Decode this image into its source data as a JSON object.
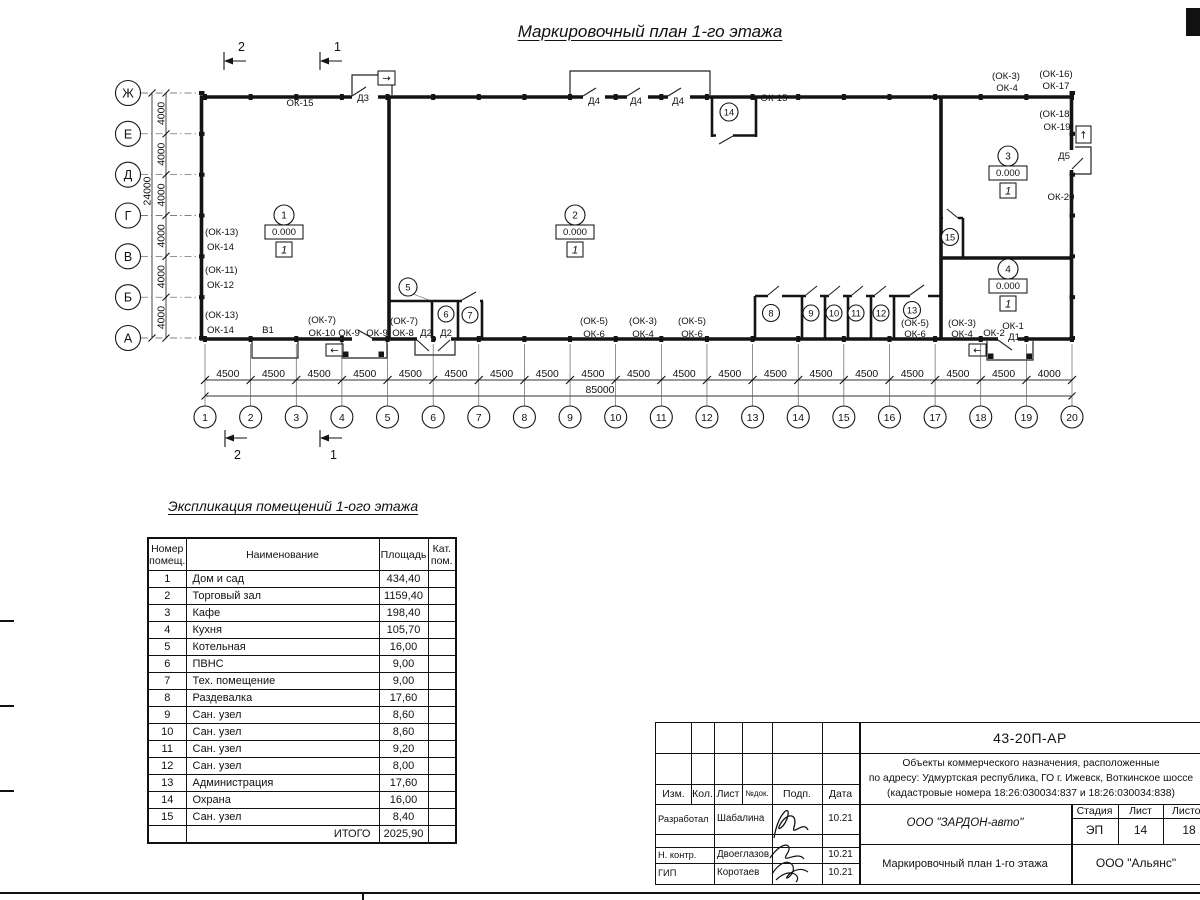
{
  "title": "Маркировочный план 1-го этажа",
  "plan": {
    "axes_bottom": [
      "1",
      "2",
      "3",
      "4",
      "5",
      "6",
      "7",
      "8",
      "9",
      "10",
      "11",
      "12",
      "13",
      "14",
      "15",
      "16",
      "17",
      "18",
      "19",
      "20"
    ],
    "axes_left": [
      "Ж",
      "Е",
      "Д",
      "Г",
      "В",
      "Б",
      "А"
    ],
    "dims_bottom": [
      "4500",
      "4500",
      "4500",
      "4500",
      "4500",
      "4500",
      "4500",
      "4500",
      "4500",
      "4500",
      "4500",
      "4500",
      "4500",
      "4500",
      "4500",
      "4500",
      "4500",
      "4500",
      "4000"
    ],
    "dim_total_bottom": "85000",
    "dims_left": [
      "4000",
      "4000",
      "4000",
      "4000",
      "4000",
      "4000"
    ],
    "dim_total_left": "24000",
    "section_markers": [
      "2",
      "1"
    ],
    "exit_arrows": {
      "right": "→",
      "left": "←",
      "up": "↑"
    },
    "top_labels": [
      "ОК-15",
      "Д3",
      "Д4",
      "Д4",
      "Д4",
      "ОК-15"
    ],
    "right_labels": [
      "(ОК-3)",
      "ОК-4",
      "(ОК-16)",
      "ОК-17",
      "(ОК-18)",
      "ОК-19",
      "Д5",
      "ОК-20"
    ],
    "left_labels": [
      "(ОК-13)",
      "ОК-14",
      "(ОК-11)",
      "ОК-12",
      "(ОК-13)",
      "ОК-14"
    ],
    "bottom_labels": [
      "В1",
      "(ОК-7)",
      "ОК-10",
      "ОК-9",
      "ОК-9",
      "(ОК-7)",
      "ОК-8",
      "Д2",
      "Д2",
      "(ОК-5)",
      "ОК-6",
      "(ОК-3)",
      "ОК-4",
      "(ОК-5)",
      "ОК-6",
      "(ОК-5)",
      "ОК-6",
      "(ОК-3)",
      "ОК-4",
      "ОК-2",
      "ОК-1",
      "Д1"
    ],
    "rooms": [
      {
        "num": "1",
        "elevation": "0.000",
        "finish": "1"
      },
      {
        "num": "2",
        "elevation": "0.000",
        "finish": "1"
      },
      {
        "num": "3",
        "elevation": "0.000",
        "finish": "1"
      },
      {
        "num": "4",
        "elevation": "0.000",
        "finish": "1"
      }
    ],
    "small_room_numbers": [
      "5",
      "6",
      "7",
      "8",
      "9",
      "10",
      "11",
      "12",
      "13",
      "14",
      "15"
    ]
  },
  "schedule": {
    "title": "Экспликация помещений 1-ого этажа",
    "headers": [
      "Номер помещ.",
      "Наименование",
      "Площадь",
      "Кат. пом."
    ],
    "rows": [
      [
        "1",
        "Дом и сад",
        "434,40"
      ],
      [
        "2",
        "Торговый зал",
        "1159,40"
      ],
      [
        "3",
        "Кафе",
        "198,40"
      ],
      [
        "4",
        "Кухня",
        "105,70"
      ],
      [
        "5",
        "Котельная",
        "16,00"
      ],
      [
        "6",
        "ПВНС",
        "9,00"
      ],
      [
        "7",
        "Тех. помещение",
        "9,00"
      ],
      [
        "8",
        "Раздевалка",
        "17,60"
      ],
      [
        "9",
        "Сан. узел",
        "8,60"
      ],
      [
        "10",
        "Сан. узел",
        "8,60"
      ],
      [
        "11",
        "Сан. узел",
        "9,20"
      ],
      [
        "12",
        "Сан. узел",
        "8,00"
      ],
      [
        "13",
        "Администрация",
        "17,60"
      ],
      [
        "14",
        "Охрана",
        "16,00"
      ],
      [
        "15",
        "Сан. узел",
        "8,40"
      ]
    ],
    "total_label": "ИТОГО",
    "total_value": "2025,90"
  },
  "titleblock": {
    "doc_number": "43-20П-АР",
    "description_lines": [
      "Объекты коммерческого назначения, расположенные",
      "по адресу: Удмуртская республика, ГО г. Ижевск, Воткинское шоссе",
      "(кадастровые номера 18:26:030034:837 и 18:26:030034:838)"
    ],
    "header_cells": [
      "Изм.",
      "Кол.",
      "Лист",
      "№док.",
      "Подп.",
      "Дата"
    ],
    "roles": [
      {
        "role": "Разработал",
        "name": "Шабалина",
        "date": "10.21"
      },
      {
        "role": "Н. контр.",
        "name": "Двоеглазов",
        "date": "10.21"
      },
      {
        "role": "ГИП",
        "name": "Коротаев",
        "date": "10.21"
      }
    ],
    "company": "ООО \"ЗАРДОН-авто\"",
    "sheet_title": "Маркировочный план 1-го этажа",
    "org": "ООО \"Альянс\"",
    "stage_label": "Стадия",
    "sheet_label": "Лист",
    "sheets_label": "Листов",
    "stage": "ЭП",
    "sheet_num": "14",
    "sheets_total": "18"
  }
}
